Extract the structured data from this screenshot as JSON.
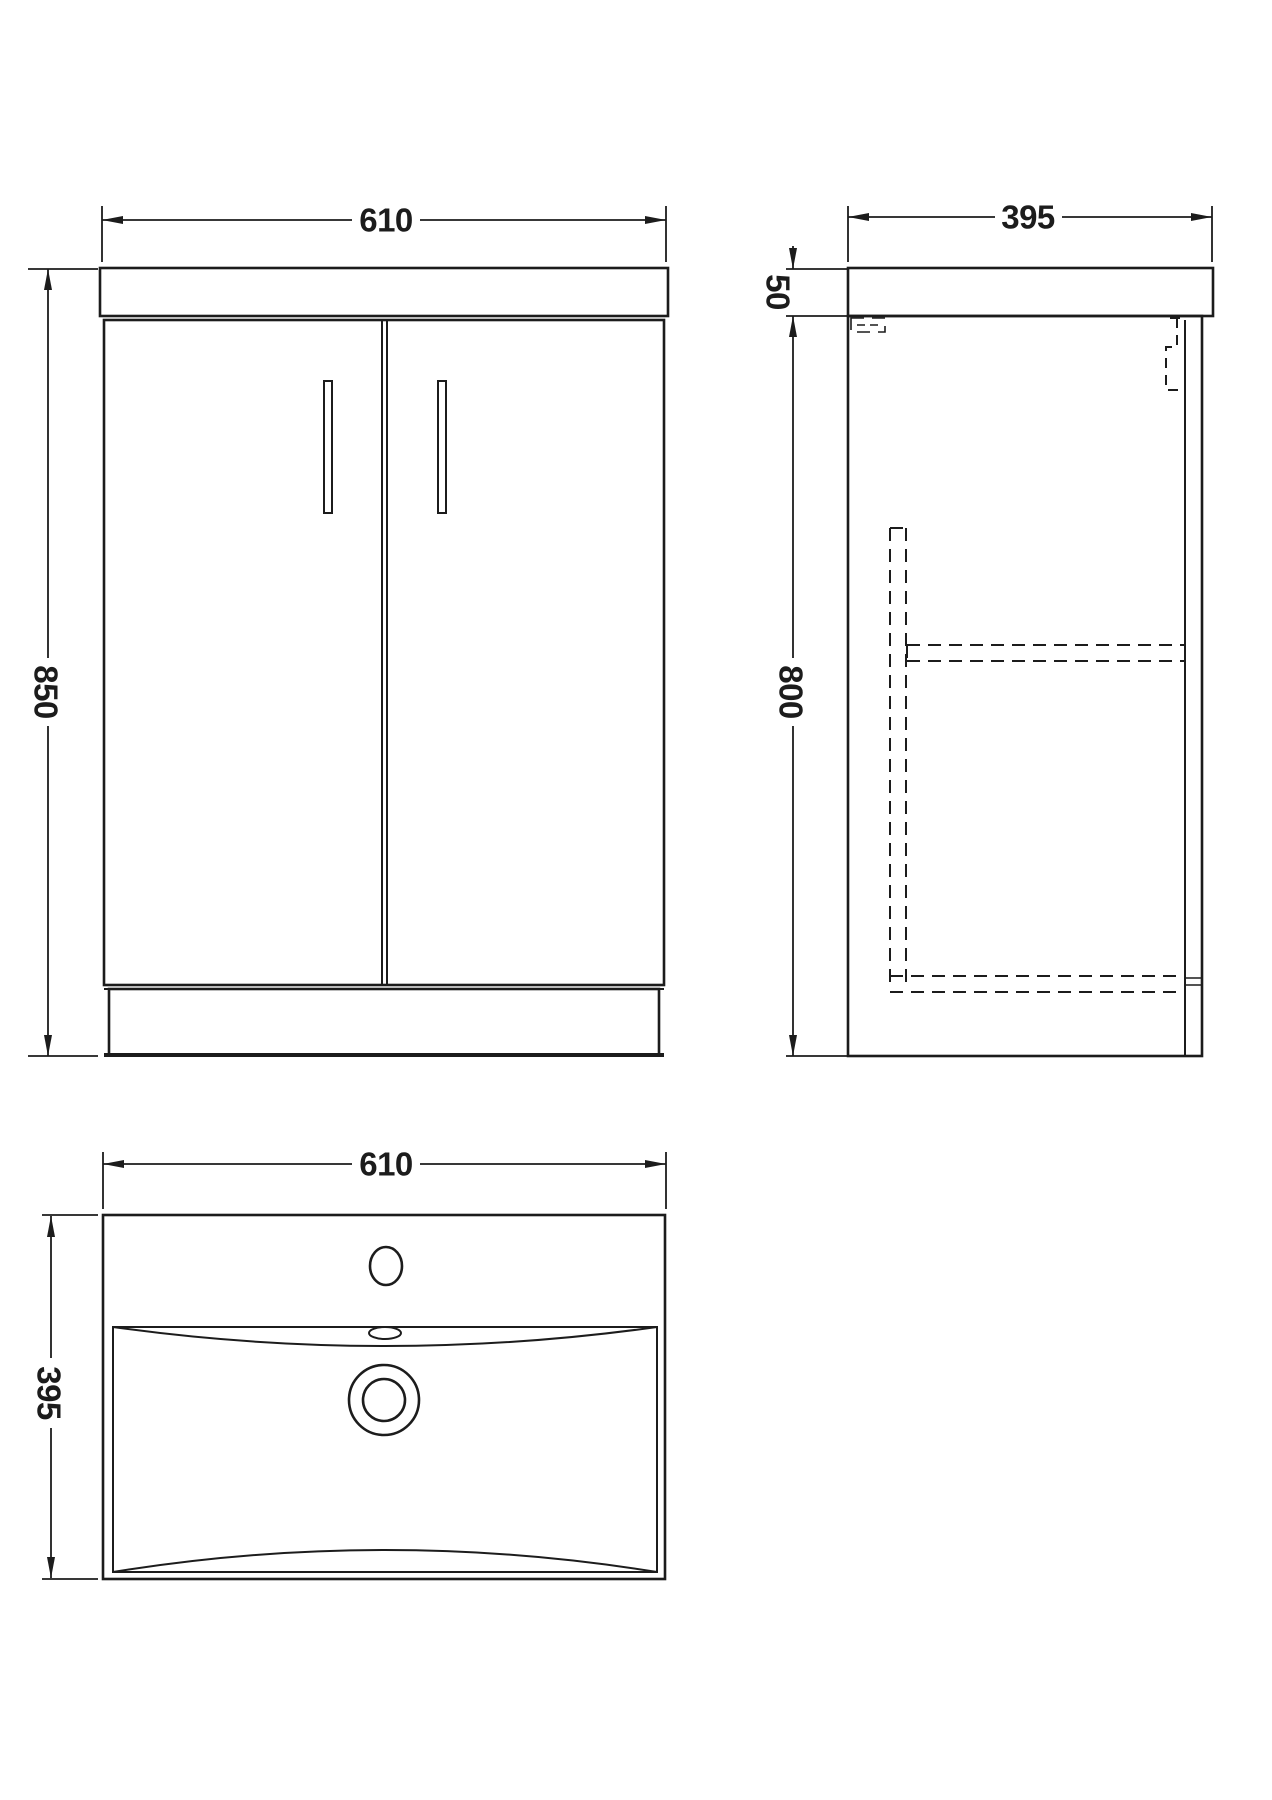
{
  "title": "Vanity unit technical drawing - three orthographic views",
  "colors": {
    "line": "#1c1c1c",
    "background": "#ffffff"
  },
  "dims": {
    "front_width": "610",
    "front_height": "850",
    "side_depth": "395",
    "side_counter_height": "50",
    "side_cabinet_height": "800",
    "plan_width": "610",
    "plan_depth": "395"
  }
}
